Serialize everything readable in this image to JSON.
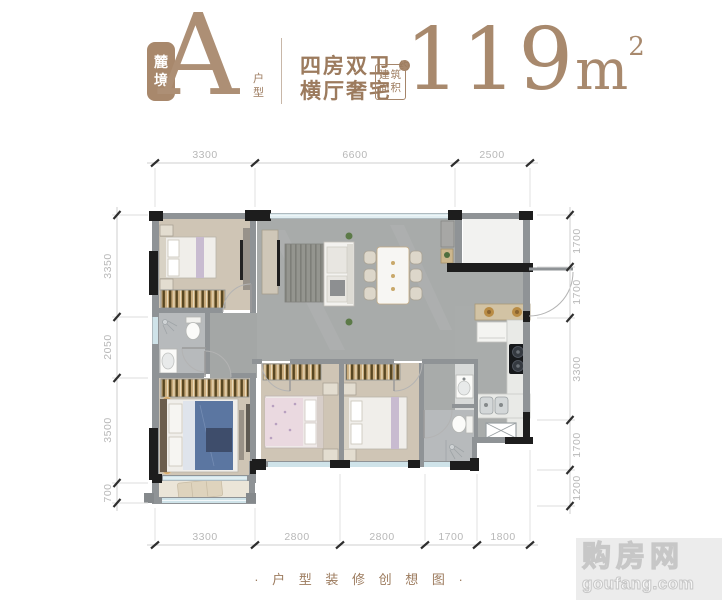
{
  "header": {
    "series_badge_chars": [
      "麓",
      "境"
    ],
    "plan_letter": "A",
    "plan_suffix_chars": [
      "户",
      "型"
    ],
    "tagline_line1": "四房双卫",
    "tagline_line2": "横厅奢宅",
    "area_label_lines": [
      "建筑",
      "面积"
    ],
    "area_label_mark": "约",
    "area_value": "119",
    "area_unit": "m",
    "area_exponent": "2"
  },
  "plan": {
    "dims_top": [
      "3300",
      "6600",
      "2500"
    ],
    "dims_bottom": [
      "3300",
      "2800",
      "2800",
      "1700",
      "1800"
    ],
    "dims_left": [
      "3350",
      "2050",
      "3500",
      "700"
    ],
    "dims_right": [
      "1700",
      "1700",
      "3300",
      "1700",
      "1200"
    ]
  },
  "footer": {
    "caption": "· 户 型 装 修 创 想 图 ·"
  },
  "watermark": {
    "name": "购房网",
    "domain": "goufang.com"
  },
  "colors": {
    "brand_brown": "#a8886c",
    "header_text": "#9c7b5e",
    "dim_text": "#b8b8b8",
    "wall_dark": "#1d1d1d",
    "wall_gray": "#8f9396",
    "window_blue": "#cfe3e9",
    "floor_living_gray": "#a8abaa",
    "floor_bedroom_beige": "#cfc5b5"
  }
}
